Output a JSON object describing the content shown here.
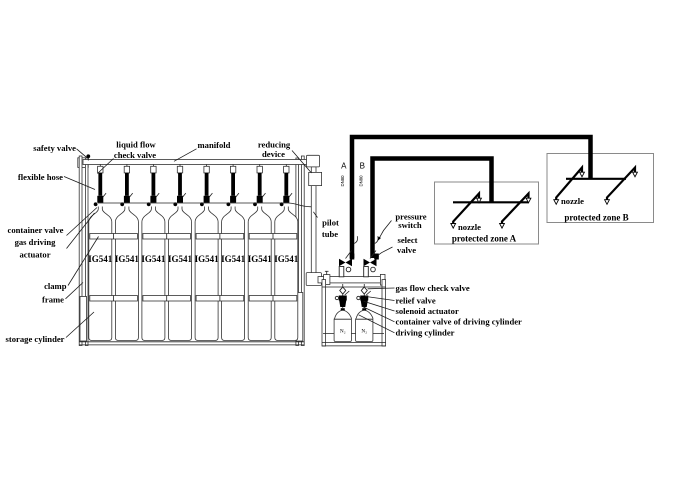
{
  "colors": {
    "background": "#ffffff",
    "line": "#000000",
    "zone_box": "#8a8a8a"
  },
  "labels": {
    "safety_valve": "safety valve",
    "liquid_flow_check_valve": [
      "liquid flow",
      "check valve"
    ],
    "manifold": "manifold",
    "reducing_device": [
      "reducing",
      "device"
    ],
    "flexible_hose": "flexible hose",
    "container_valve_actuator": [
      "container valve",
      "gas driving",
      "actuator"
    ],
    "clamp": "clamp",
    "frame": "frame",
    "storage_cylinder": "storage cylinder",
    "pilot_tube": [
      "pilot",
      "tube"
    ],
    "pressure_switch": [
      "pressure",
      "switch"
    ],
    "select_valve": [
      "select",
      "valve"
    ],
    "gas_flow_check_valve": "gas flow check valve",
    "relief_valve": "relief valve",
    "solenoid_actuator": "solenoid actuator",
    "container_valve_of_driving_cylinder": "container valve of driving cylinder",
    "driving_cylinder": "driving cylinder"
  },
  "pipes": {
    "zone_line_a": "A",
    "zone_line_b": "B",
    "size_label": "DN80"
  },
  "bank": {
    "cylinder_label": "IG541",
    "cylinder_count": 8
  },
  "driving_unit": {
    "cylinder_label": "N₂",
    "cylinder_count": 2
  },
  "zones": {
    "a": {
      "name": "protected zone A",
      "nozzle": "nozzle"
    },
    "b": {
      "name": "protected zone B",
      "nozzle": "nozzle"
    }
  }
}
